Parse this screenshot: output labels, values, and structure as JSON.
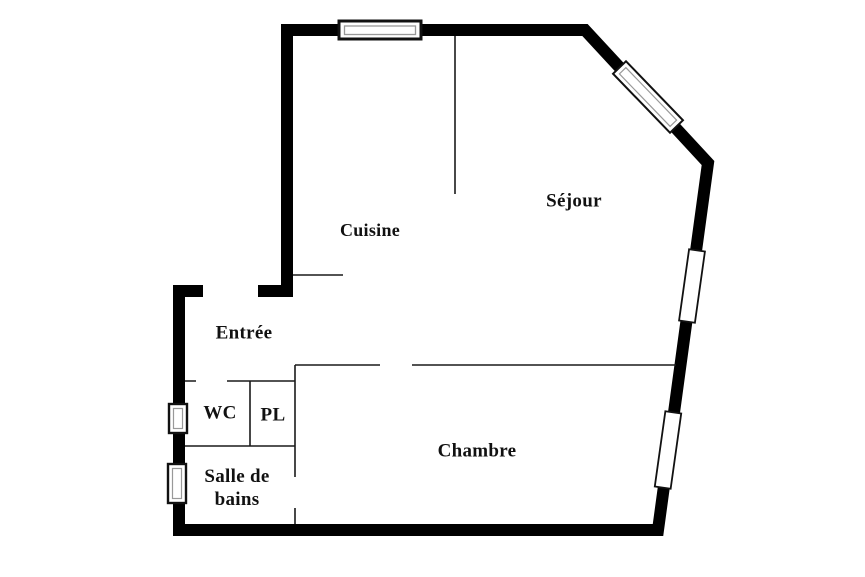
{
  "diagram": {
    "type": "apartment-floor-plan"
  },
  "rooms": {
    "cuisine": {
      "label": "Cuisine"
    },
    "sejour": {
      "label": "Séjour"
    },
    "entree": {
      "label": "Entrée"
    },
    "wc": {
      "label": "WC"
    },
    "pl": {
      "label": "PL"
    },
    "salle_de_bains": {
      "label": "Salle de bains"
    },
    "chambre": {
      "label": "Chambre"
    }
  },
  "colors": {
    "background": "#ffffff",
    "wall": "#000000",
    "interior_wall": "#1a1a1a",
    "window_fill": "#ffffff",
    "window_border": "#111111",
    "window_inner": "#999999",
    "label_text": "#111111"
  }
}
